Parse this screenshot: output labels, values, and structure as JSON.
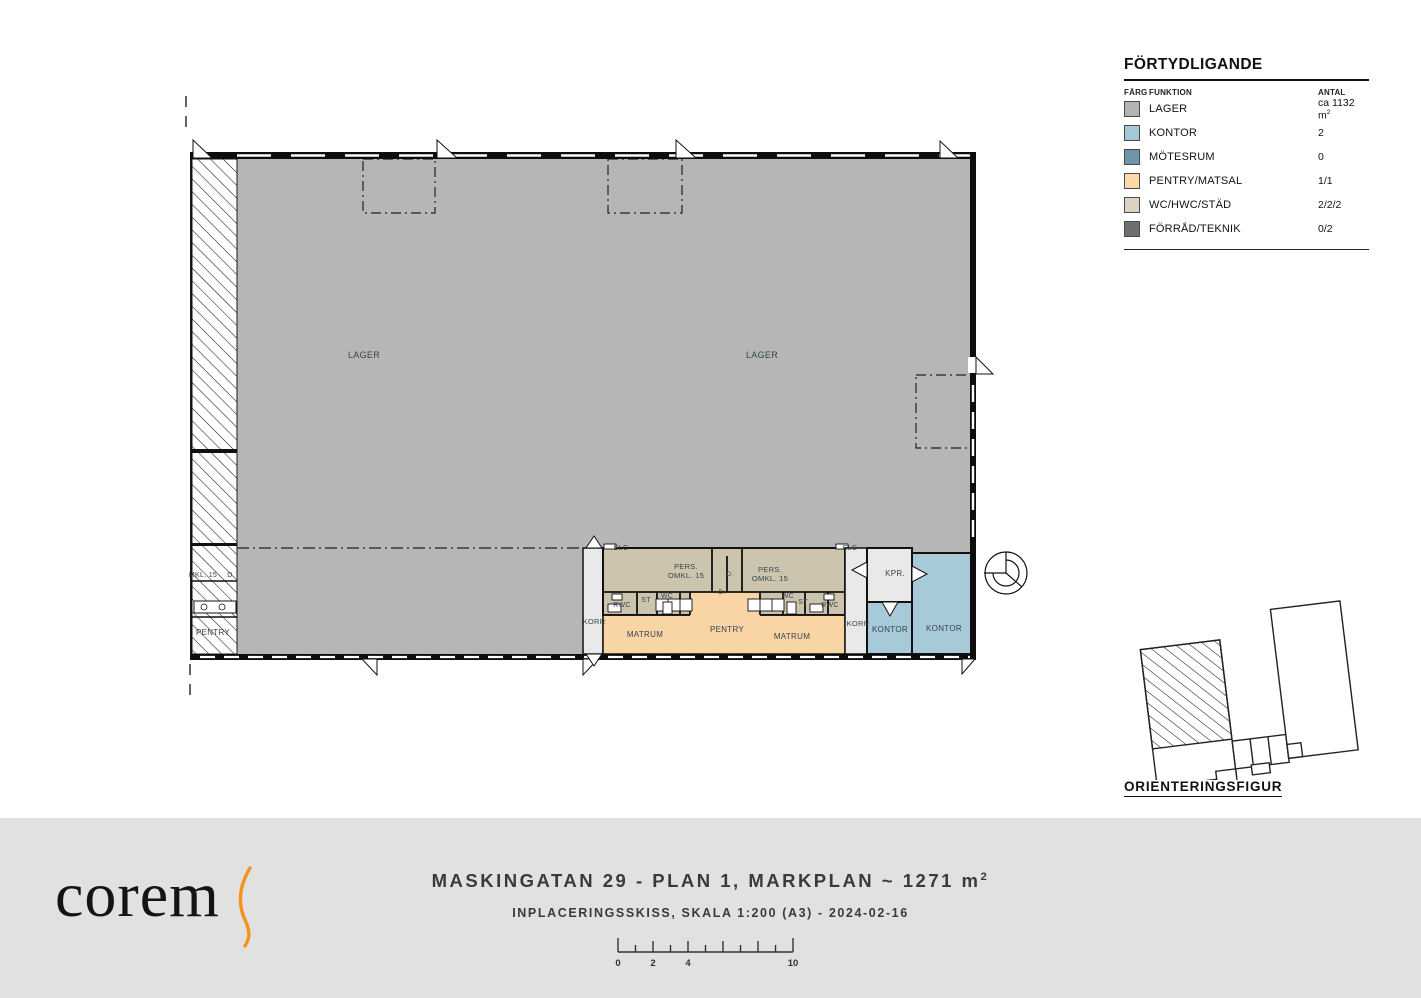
{
  "colors": {
    "lager": "#b5b6b5",
    "kontor": "#a7cad8",
    "motesrum": "#6d95a8",
    "pentry": "#f9d5a5",
    "wc": "#d6cdb8",
    "band_wc": "#cdc4ad",
    "forrad": "#6f6f6f",
    "corridor": "#e9e9e9",
    "accent_orange": "#f5921e",
    "footer_bg": "#e1e1e1"
  },
  "legend": {
    "title": "FÖRTYDLIGANDE",
    "col_farg": "FÄRG",
    "col_funktion": "FUNKTION",
    "col_antal": "ANTAL",
    "rows": [
      {
        "label": "LAGER",
        "antal": "ca 1132 m",
        "antal_sup": "2",
        "color": "#b3b4b3"
      },
      {
        "label": "KONTOR",
        "antal": "2",
        "color": "#a5c8d7"
      },
      {
        "label": "MÖTESRUM",
        "antal": "0",
        "color": "#6d95a8"
      },
      {
        "label": "PENTRY/MATSAL",
        "antal": "1/1",
        "color": "#fcd9a9"
      },
      {
        "label": "WC/HWC/STÄD",
        "antal": "2/2/2",
        "color": "#dbd2bf"
      },
      {
        "label": "FÖRRÅD/TEKNIK",
        "antal": "0/2",
        "color": "#6f6f6f"
      }
    ]
  },
  "orientation": {
    "label": "ORIENTERINGSFIGUR"
  },
  "plan": {
    "labels": [
      {
        "t": "LAGER",
        "x": 364,
        "y": 358,
        "s": 9
      },
      {
        "t": "LAGER",
        "x": 762,
        "y": 358,
        "s": 9
      },
      {
        "t": "ELC",
        "x": 621,
        "y": 550,
        "s": 7
      },
      {
        "t": "ELC",
        "x": 850,
        "y": 550,
        "s": 7
      },
      {
        "t": "PERS.",
        "x": 686,
        "y": 569,
        "s": 7.5
      },
      {
        "t": "OMKL. 15",
        "x": 686,
        "y": 578,
        "s": 7.5
      },
      {
        "t": "PERS.",
        "x": 770,
        "y": 572,
        "s": 7.5
      },
      {
        "t": "OMKL. 15",
        "x": 770,
        "y": 581,
        "s": 7.5
      },
      {
        "t": "D.",
        "x": 730,
        "y": 576,
        "s": 6.5
      },
      {
        "t": "D.",
        "x": 722,
        "y": 594,
        "s": 6.5
      },
      {
        "t": "RWC",
        "x": 622,
        "y": 607,
        "s": 7
      },
      {
        "t": "ST",
        "x": 646,
        "y": 602,
        "s": 7
      },
      {
        "t": "WC",
        "x": 667,
        "y": 598,
        "s": 7
      },
      {
        "t": "WC",
        "x": 788,
        "y": 598,
        "s": 7
      },
      {
        "t": "ST",
        "x": 803,
        "y": 604,
        "s": 7
      },
      {
        "t": "RWC",
        "x": 830,
        "y": 607,
        "s": 7
      },
      {
        "t": "KORR",
        "x": 594,
        "y": 624,
        "s": 7.5
      },
      {
        "t": "KORR",
        "x": 858,
        "y": 626,
        "s": 7.5
      },
      {
        "t": "MATRUM",
        "x": 645,
        "y": 637,
        "s": 8
      },
      {
        "t": "PENTRY",
        "x": 727,
        "y": 632,
        "s": 8
      },
      {
        "t": "MATRUM",
        "x": 792,
        "y": 639,
        "s": 8
      },
      {
        "t": "KPR.",
        "x": 895,
        "y": 576,
        "s": 8
      },
      {
        "t": "KONTOR",
        "x": 890,
        "y": 632,
        "s": 8
      },
      {
        "t": "KONTOR",
        "x": 944,
        "y": 631,
        "s": 8
      },
      {
        "t": "MKL. 15",
        "x": 203,
        "y": 577,
        "s": 7
      },
      {
        "t": "D.",
        "x": 231,
        "y": 577,
        "s": 7
      },
      {
        "t": "PENTRY",
        "x": 213,
        "y": 635,
        "s": 8
      }
    ]
  },
  "footer": {
    "logo_text": "corem",
    "title_main": "MASKINGATAN 29 - PLAN 1, MARKPLAN ~ 1271 m",
    "title_sup": "2",
    "subtitle": "INPLACERINGSSKISS, SKALA 1:200 (A3) - 2024-02-16",
    "scale": {
      "meters": 10,
      "labeled_ticks": [
        0,
        2,
        4,
        10
      ]
    }
  }
}
